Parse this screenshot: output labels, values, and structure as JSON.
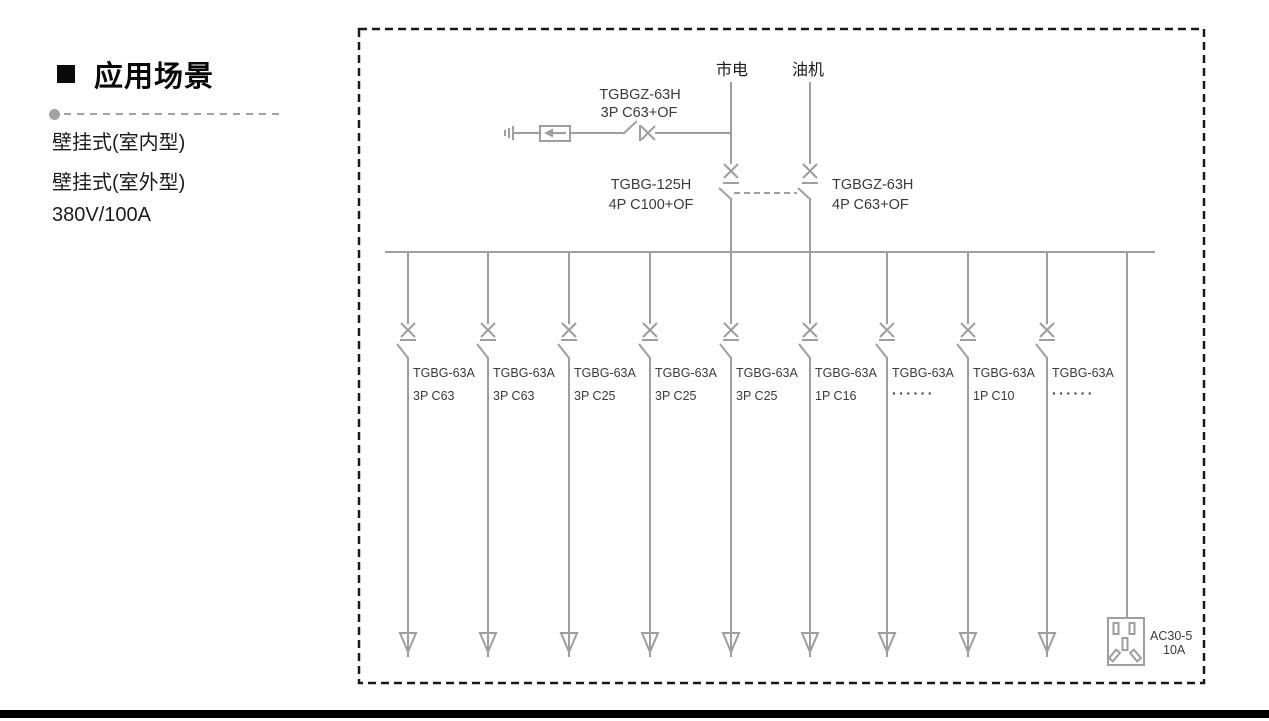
{
  "left_panel": {
    "heading": "应用场景",
    "items": [
      "壁挂式(室内型)",
      "壁挂式(室外型)",
      "380V/100A"
    ]
  },
  "diagram": {
    "mains_label": "市电",
    "generator_label": "油机",
    "spd_breaker_label": {
      "line1": "TGBGZ-63H",
      "line2": "3P C63+OF"
    },
    "mains_breaker_label": {
      "line1": "TGBG-125H",
      "line2": "4P C100+OF"
    },
    "generator_breaker_label": {
      "line1": "TGBGZ-63H",
      "line2": "4P C63+OF"
    },
    "branches": [
      {
        "model": "TGBG-63A",
        "rating": "3P C63"
      },
      {
        "model": "TGBG-63A",
        "rating": "3P C63"
      },
      {
        "model": "TGBG-63A",
        "rating": "3P C25"
      },
      {
        "model": "TGBG-63A",
        "rating": "3P C25"
      },
      {
        "model": "TGBG-63A",
        "rating": "3P C25"
      },
      {
        "model": "TGBG-63A",
        "rating": "1P C16"
      },
      {
        "model": "TGBG-63A",
        "rating": "······"
      },
      {
        "model": "TGBG-63A",
        "rating": "1P C10"
      },
      {
        "model": "TGBG-63A",
        "rating": "······"
      }
    ],
    "socket_label": {
      "line1": "AC30-5",
      "line2": "10A"
    },
    "colors": {
      "line": "#9e9e9e",
      "text": "#3b3b3b",
      "border": "#1a1a1a"
    }
  }
}
